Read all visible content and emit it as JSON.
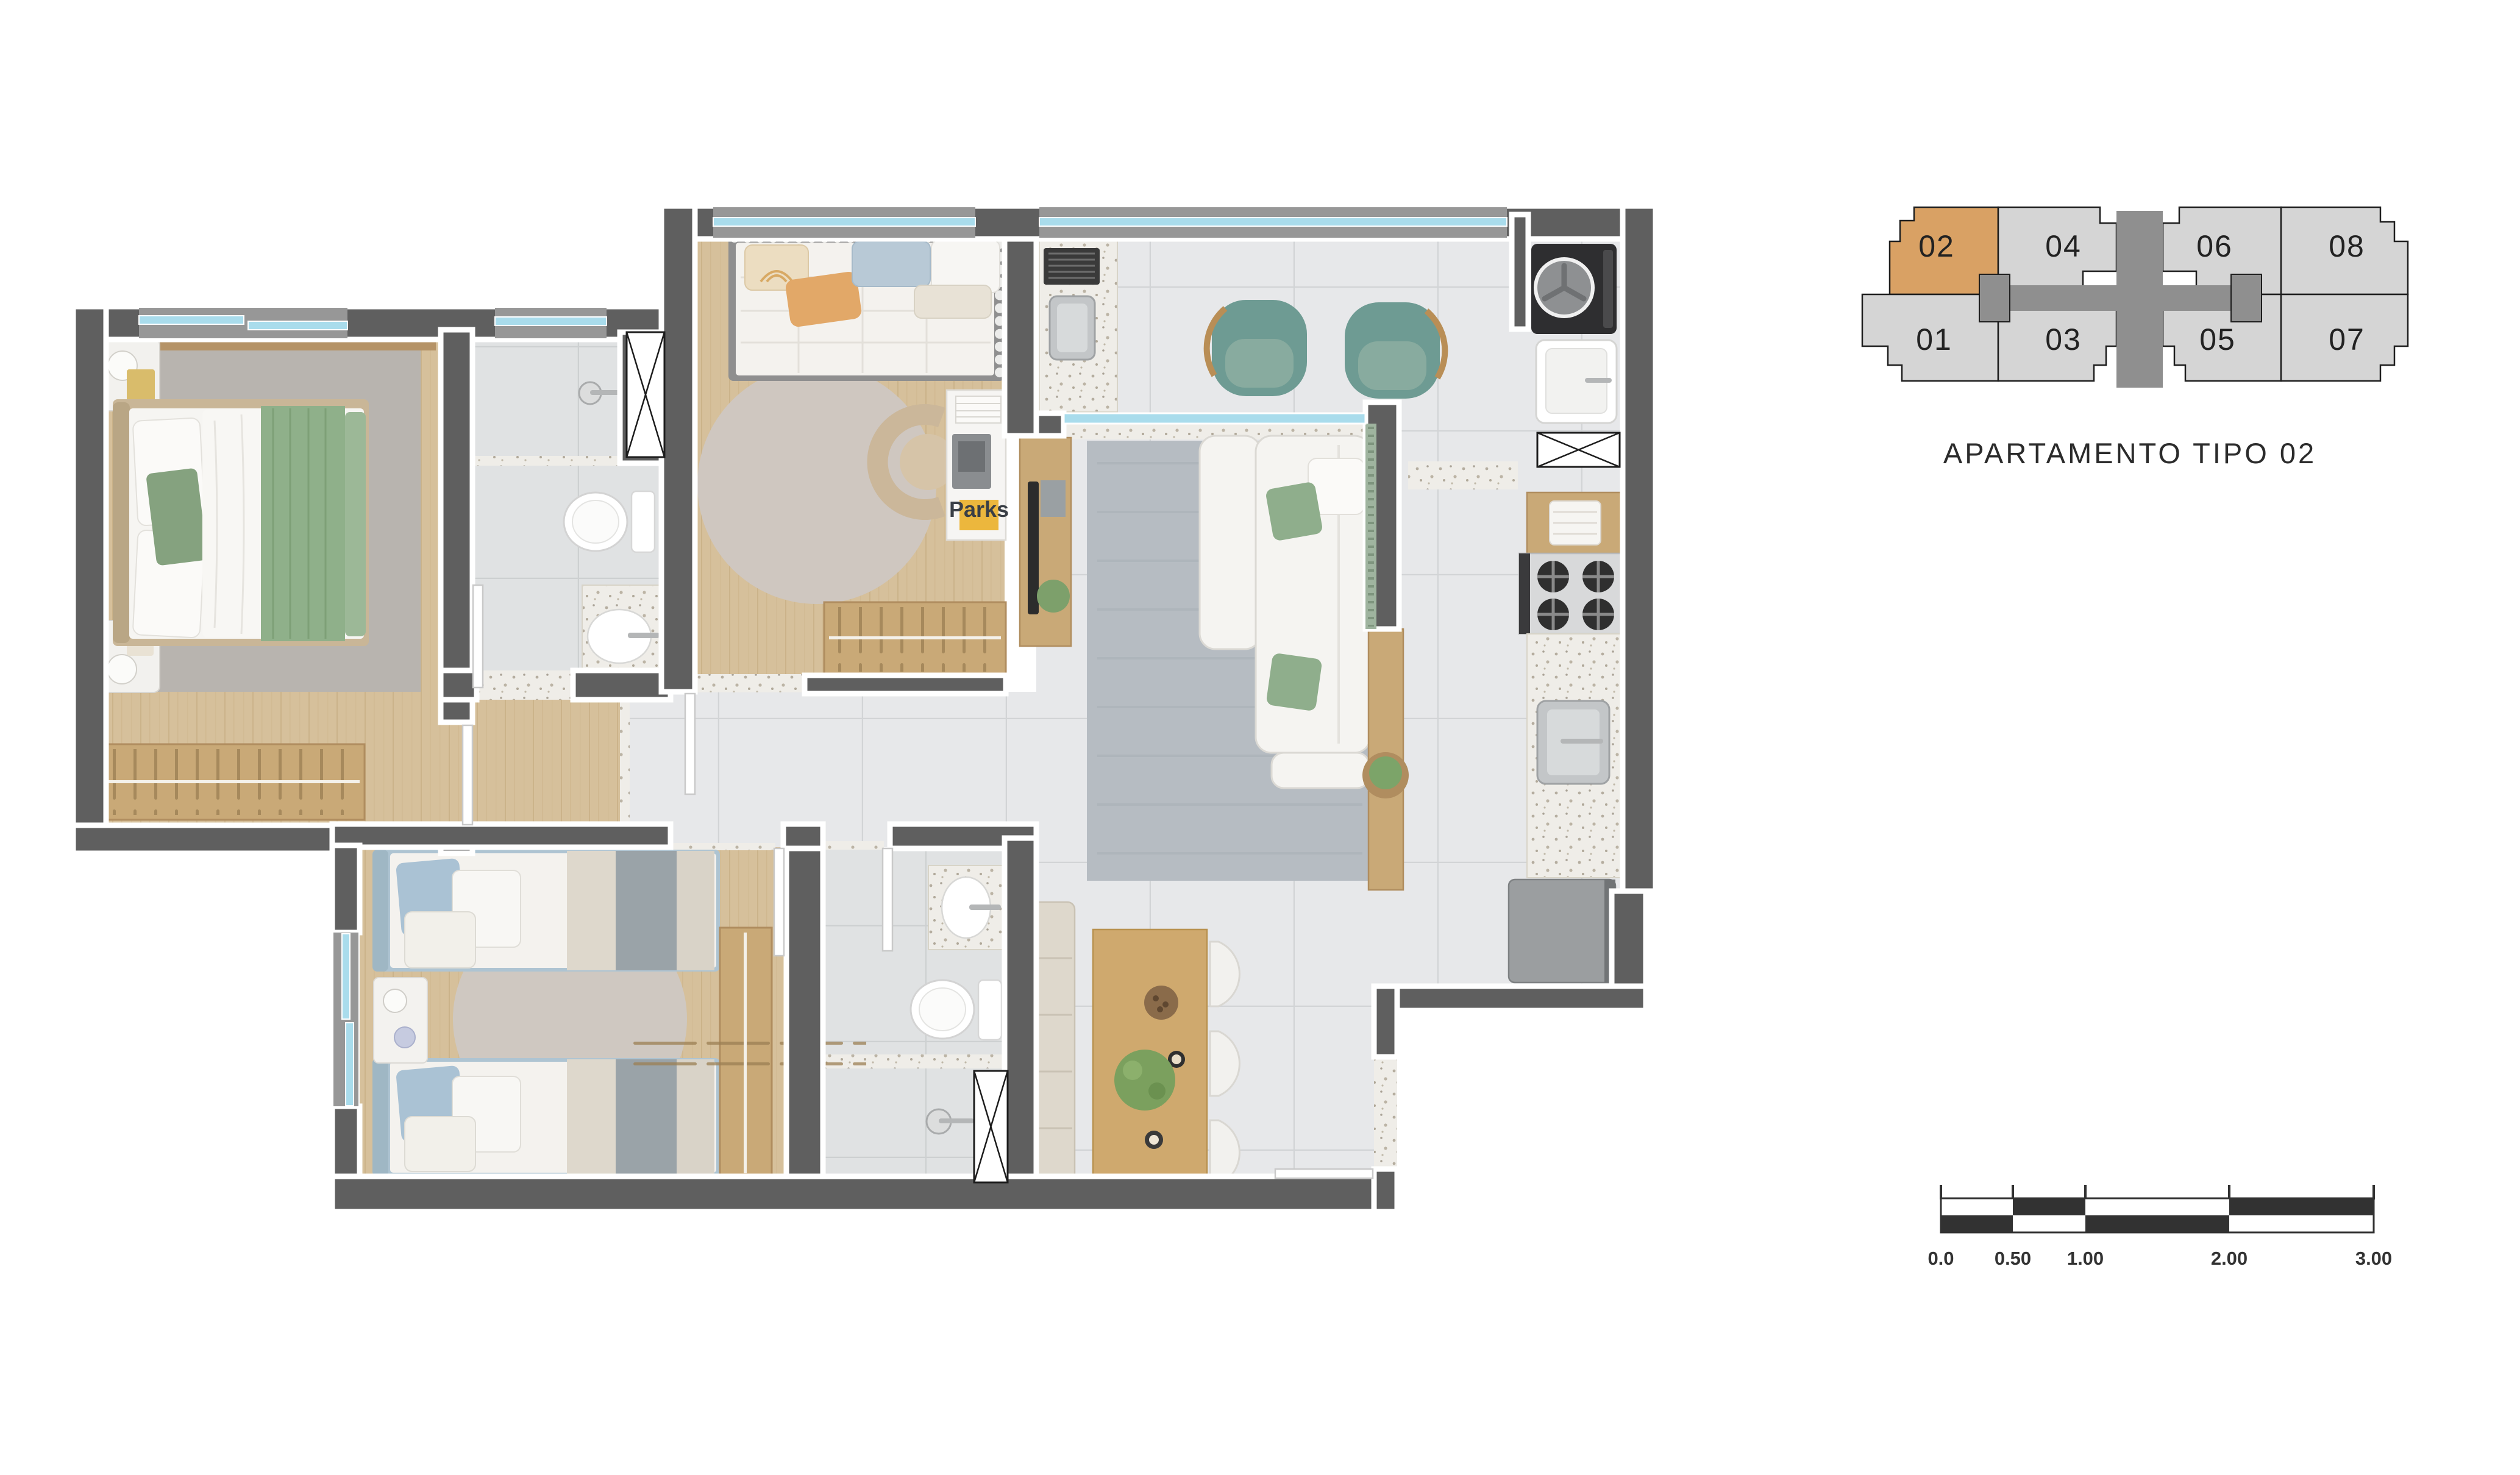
{
  "title": "APARTAMENTO TIPO 02",
  "keyplan": {
    "highlighted_unit": "02",
    "highlight_color": "#D9A164",
    "unit_color": "#D5D5D5",
    "core_color": "#8F8F8F",
    "outline_color": "#1E1E1E",
    "units": [
      {
        "label": "02"
      },
      {
        "label": "04"
      },
      {
        "label": "06"
      },
      {
        "label": "08"
      },
      {
        "label": "01"
      },
      {
        "label": "03"
      },
      {
        "label": "05"
      },
      {
        "label": "07"
      }
    ]
  },
  "scale_bar": {
    "labels": [
      "0.0",
      "0.50",
      "1.00",
      "2.00",
      "3.00"
    ],
    "color": "#323232"
  },
  "floor_plan": {
    "desk_brand_label": "Parks",
    "colors": {
      "wall": "#5F5F5F",
      "wood_floor": "#D6C09B",
      "tile_floor": "#E7E8EA",
      "bath_tile": "#E0E2E3",
      "window_glass": "#A9DCEC",
      "rug_master": "#B8B4AF",
      "rug_round": "#CFC7C0",
      "rug_living": "#B6BCC2",
      "green_textile": "#8FB08A",
      "teal_armchair": "#6E9B93",
      "twin_bed_blue": "#A9C1D3",
      "kitchen_wood": "#C9A977",
      "counter_speckle": "#EFEDE8",
      "accent_yellow": "#ECB73D"
    }
  }
}
